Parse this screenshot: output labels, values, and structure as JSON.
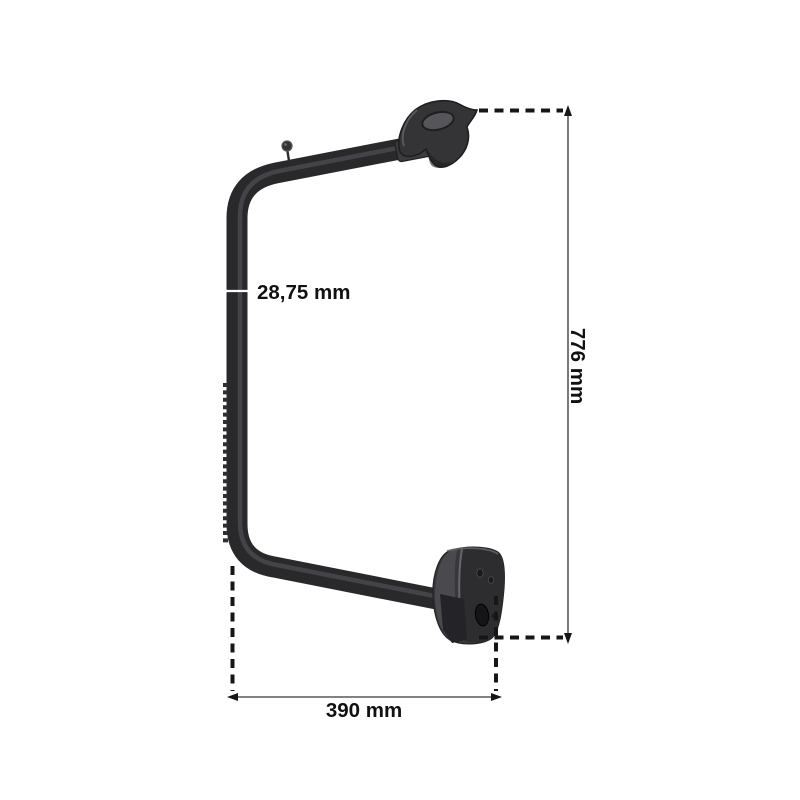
{
  "product": {
    "description": "Black truck side-mirror support arm with top pivot bracket and bottom mounting plate, shown with measurement annotations",
    "arm_color": "#29292c",
    "arm_highlight": "#4d4d52",
    "bracket_fill": "#343437",
    "plate_fill": "#38383b",
    "plate_light_face": "#4a4a4e",
    "plate_dark_face": "#2d2d30"
  },
  "dimensions": {
    "tube_diameter": {
      "label": "28,75 mm"
    },
    "overall_height": {
      "label": "776 mm"
    },
    "overall_width": {
      "label": "390 mm"
    }
  },
  "annotation_style": {
    "dashed_line_color": "#161616",
    "dimension_line_color": "#58585a",
    "arrow_color": "#161616",
    "label_color": "#111111",
    "diameter_tick_color": "#ffffff"
  }
}
